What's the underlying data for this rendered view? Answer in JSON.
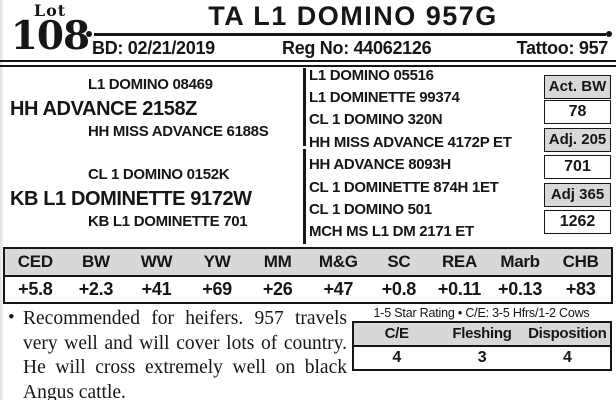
{
  "colors": {
    "ink": "#161616",
    "gray_fill": "#d8d8d8"
  },
  "icons": {
    "rule_end_dot": "small filled circle at each end of title rule"
  },
  "lot": {
    "label": "Lot",
    "number": "108"
  },
  "title": "TA L1 DOMINO 957G",
  "header_row": {
    "bd": "BD: 02/21/2019",
    "reg_no": "Reg No: 44062126",
    "tattoo": "Tattoo: 957"
  },
  "pedigree": {
    "sire_line": {
      "top": "L1 DOMINO 08469",
      "name": "HH ADVANCE 2158Z",
      "bottom": "HH MISS ADVANCE 6188S"
    },
    "dam_line": {
      "top": "CL 1 DOMINO 0152K",
      "name": "KB L1 DOMINETTE 9172W",
      "bottom": "KB L1 DOMINETTE 701"
    },
    "extended": [
      "L1 DOMINO 05516",
      "L1 DOMINETTE 99374",
      "CL 1 DOMINO 320N",
      "HH MISS ADVANCE 4172P ET",
      "HH ADVANCE 8093H",
      "CL 1 DOMINETTE 874H 1ET",
      "CL 1 DOMINO 501",
      "MCH MS L1 DM 2171 ET"
    ]
  },
  "weights": [
    {
      "label": "Act. BW",
      "value": "78"
    },
    {
      "label": "Adj. 205",
      "value": "701"
    },
    {
      "label": "Adj 365",
      "value": "1262"
    }
  ],
  "epd": {
    "headers": [
      "CED",
      "BW",
      "WW",
      "YW",
      "MM",
      "M&G",
      "SC",
      "REA",
      "Marb",
      "CHB"
    ],
    "values": [
      "+5.8",
      "+2.3",
      "+41",
      "+69",
      "+26",
      "+47",
      "+0.8",
      "+0.11",
      "+0.13",
      "+83"
    ]
  },
  "notes": {
    "bullet": "•",
    "lines": [
      "Recommended for heifers. 957 travels",
      "very well and will cover lots of country.",
      "He will cross extremely well on black",
      "Angus cattle."
    ]
  },
  "rating": {
    "caption": "1-5 Star Rating • C/E: 3-5 Hfrs/1-2 Cows",
    "headers": [
      "C/E",
      "Fleshing",
      "Disposition"
    ],
    "values": [
      "4",
      "3",
      "4"
    ]
  }
}
